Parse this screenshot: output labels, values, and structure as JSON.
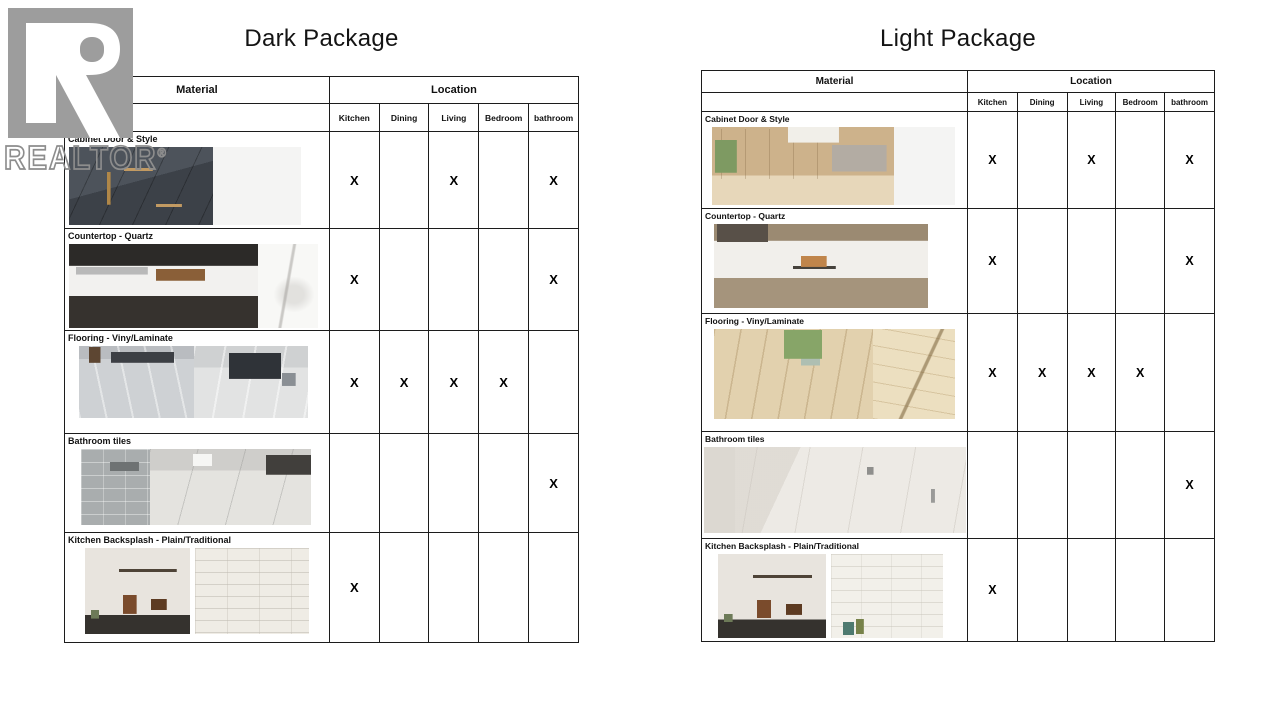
{
  "watermark": {
    "brand": "REALTOR",
    "registered": "®"
  },
  "mark_symbol": "X",
  "packages": [
    {
      "title": "Dark Package",
      "header": {
        "material": "Material",
        "location": "Location",
        "columns": [
          "Kitchen",
          "Dining",
          "Living",
          "Bedroom",
          "bathroom"
        ]
      },
      "layout": {
        "col_widths": [
          265,
          50,
          50,
          50,
          50,
          50
        ],
        "header1_h": 27,
        "header2_h": 28,
        "table_margin_top": 22
      },
      "rows": [
        {
          "material": "Cabinet Door & Style",
          "marks": [
            1,
            0,
            1,
            0,
            1
          ],
          "row_h": 97,
          "strip": {
            "w": 232,
            "h": 78,
            "ind": 4,
            "gap": 0
          },
          "photos": [
            {
              "name": "dark-cabinet-photo",
              "cls": "dark-cabinet",
              "w": 62
            },
            {
              "name": "white-panel-swatch-photo",
              "cls": "white-panel",
              "w": 38
            }
          ]
        },
        {
          "material": "Countertop - Quartz",
          "marks": [
            1,
            0,
            0,
            0,
            1
          ],
          "row_h": 102,
          "strip": {
            "w": 249,
            "h": 84,
            "ind": 4,
            "gap": 0
          },
          "photos": [
            {
              "name": "dark-kitchen-quartz-counter-photo",
              "cls": "quartz-scene-dark",
              "w": 76
            },
            {
              "name": "marble-swatch-photo",
              "cls": "marble-swatch",
              "w": 24
            }
          ]
        },
        {
          "material": "Flooring - Viny/Laminate",
          "marks": [
            1,
            1,
            1,
            1,
            0
          ],
          "row_h": 103,
          "strip": {
            "w": 229,
            "h": 72,
            "ind": 14,
            "gap": 0
          },
          "photos": [
            {
              "name": "gray-laminate-floor-photo",
              "cls": "gray-floor-a",
              "w": 50
            },
            {
              "name": "gray-laminate-room-photo",
              "cls": "gray-floor-b",
              "w": 50
            }
          ]
        },
        {
          "material": "Bathroom tiles",
          "marks": [
            0,
            0,
            0,
            0,
            1
          ],
          "row_h": 99,
          "strip": {
            "w": 230,
            "h": 76,
            "ind": 16,
            "gap": 0
          },
          "photos": [
            {
              "name": "gray-shower-tile-photo",
              "cls": "tile-wall",
              "w": 30
            },
            {
              "name": "large-gray-tiles-photo",
              "cls": "big-tiles",
              "w": 70
            }
          ]
        },
        {
          "material": "Kitchen Backsplash - Plain/Traditional",
          "marks": [
            1,
            0,
            0,
            0,
            0
          ],
          "row_h": 110,
          "strip": {
            "w": 228,
            "h": 86,
            "ind": 20,
            "gap": 5
          },
          "photos": [
            {
              "name": "backsplash-kitchen-photo",
              "cls": "backsplash-photo",
              "w": 46
            },
            {
              "name": "white-brick-tile-photo",
              "cls": "white-brick",
              "w": 50
            }
          ]
        }
      ]
    },
    {
      "title": "Light Package",
      "header": {
        "material": "Material",
        "location": "Location",
        "columns": [
          "Kitchen",
          "Dining",
          "Living",
          "Bedroom",
          "bathroom"
        ]
      },
      "layout": {
        "col_widths": [
          266,
          50,
          50,
          49,
          49,
          50
        ],
        "header1_h": 22,
        "header2_h": 19,
        "table_margin_top": 16
      },
      "rows": [
        {
          "material": "Cabinet Door & Style",
          "marks": [
            1,
            0,
            1,
            0,
            1
          ],
          "row_h": 97,
          "strip": {
            "w": 243,
            "h": 78,
            "ind": 10,
            "gap": 0
          },
          "photos": [
            {
              "name": "light-wood-kitchen-photo",
              "cls": "light-wood-kitchen",
              "w": 75
            },
            {
              "name": "white-panel-swatch-photo",
              "cls": "white-panel",
              "w": 25
            }
          ]
        },
        {
          "material": "Countertop - Quartz",
          "marks": [
            1,
            0,
            0,
            0,
            1
          ],
          "row_h": 105,
          "strip": {
            "w": 214,
            "h": 84,
            "ind": 12,
            "gap": 0
          },
          "photos": [
            {
              "name": "light-quartz-island-photo",
              "cls": "quartz-scene-light",
              "w": 100
            }
          ]
        },
        {
          "material": "Flooring - Viny/Laminate",
          "marks": [
            1,
            1,
            1,
            1,
            0
          ],
          "row_h": 118,
          "strip": {
            "w": 241,
            "h": 90,
            "ind": 12,
            "gap": 0
          },
          "photos": [
            {
              "name": "light-plank-floor-photo",
              "cls": "light-plank",
              "w": 66
            },
            {
              "name": "plank-swatch-photo",
              "cls": "plank-swatch",
              "w": 34
            }
          ]
        },
        {
          "material": "Bathroom tiles",
          "marks": [
            0,
            0,
            0,
            0,
            1
          ],
          "row_h": 107,
          "strip": {
            "w": 262,
            "h": 86,
            "ind": 2,
            "gap": 0
          },
          "photos": [
            {
              "name": "light-bathroom-photo",
              "cls": "light-bath",
              "w": 100
            }
          ]
        },
        {
          "material": "Kitchen Backsplash - Plain/Traditional",
          "marks": [
            1,
            0,
            0,
            0,
            0
          ],
          "row_h": 103,
          "strip": {
            "w": 229,
            "h": 84,
            "ind": 16,
            "gap": 5
          },
          "photos": [
            {
              "name": "backsplash-kitchen-photo",
              "cls": "backsplash-photo",
              "w": 47
            },
            {
              "name": "white-brick-tile-photo",
              "cls": "white-brick-light",
              "w": 49
            }
          ]
        }
      ]
    }
  ]
}
